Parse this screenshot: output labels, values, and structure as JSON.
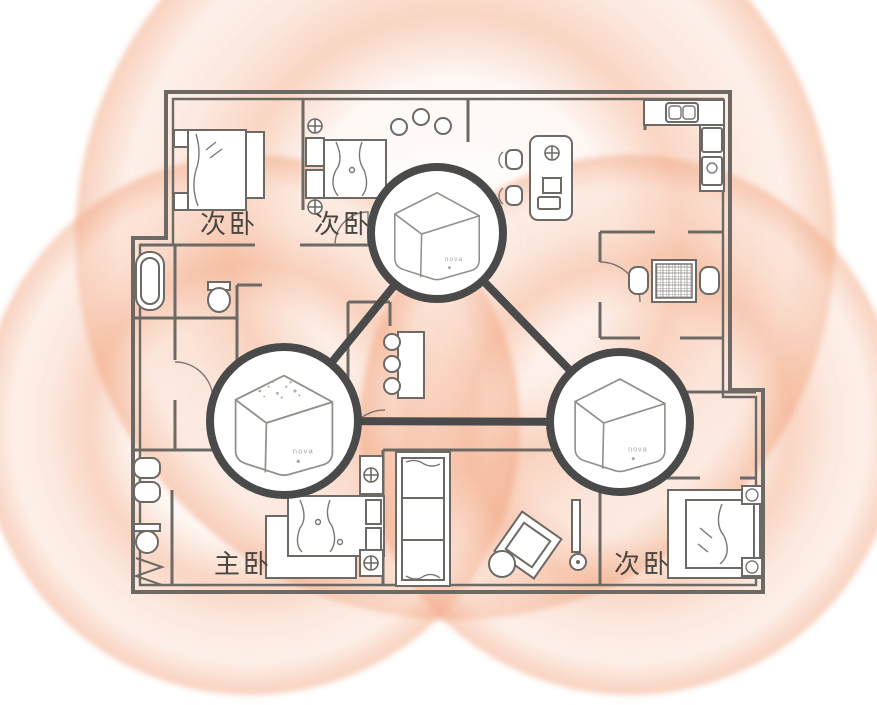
{
  "scene": {
    "description": "Mesh Wi-Fi system coverage diagram over an apartment floor plan: three nova mesh nodes linked in a triangle, each surrounded by orange signal-coverage halos.",
    "room_labels": [
      {
        "id": "bedroom-top-left",
        "text": "次卧"
      },
      {
        "id": "bedroom-top-middle",
        "text": "次卧"
      },
      {
        "id": "bedroom-master",
        "text": "主卧"
      },
      {
        "id": "bedroom-bottom-right",
        "text": "次卧"
      }
    ],
    "devices": [
      {
        "id": "node-top",
        "label": "nova"
      },
      {
        "id": "node-bottom-left",
        "label": "nova"
      },
      {
        "id": "node-bottom-right",
        "label": "nova"
      }
    ],
    "colors": {
      "coverage_strong": "#F09B72",
      "coverage_mid": "#F6B18C",
      "coverage_light": "#FAD6C4",
      "wall": "#6D6A66",
      "node_outline": "#4A4A4A",
      "label_text": "#4A4540"
    }
  }
}
